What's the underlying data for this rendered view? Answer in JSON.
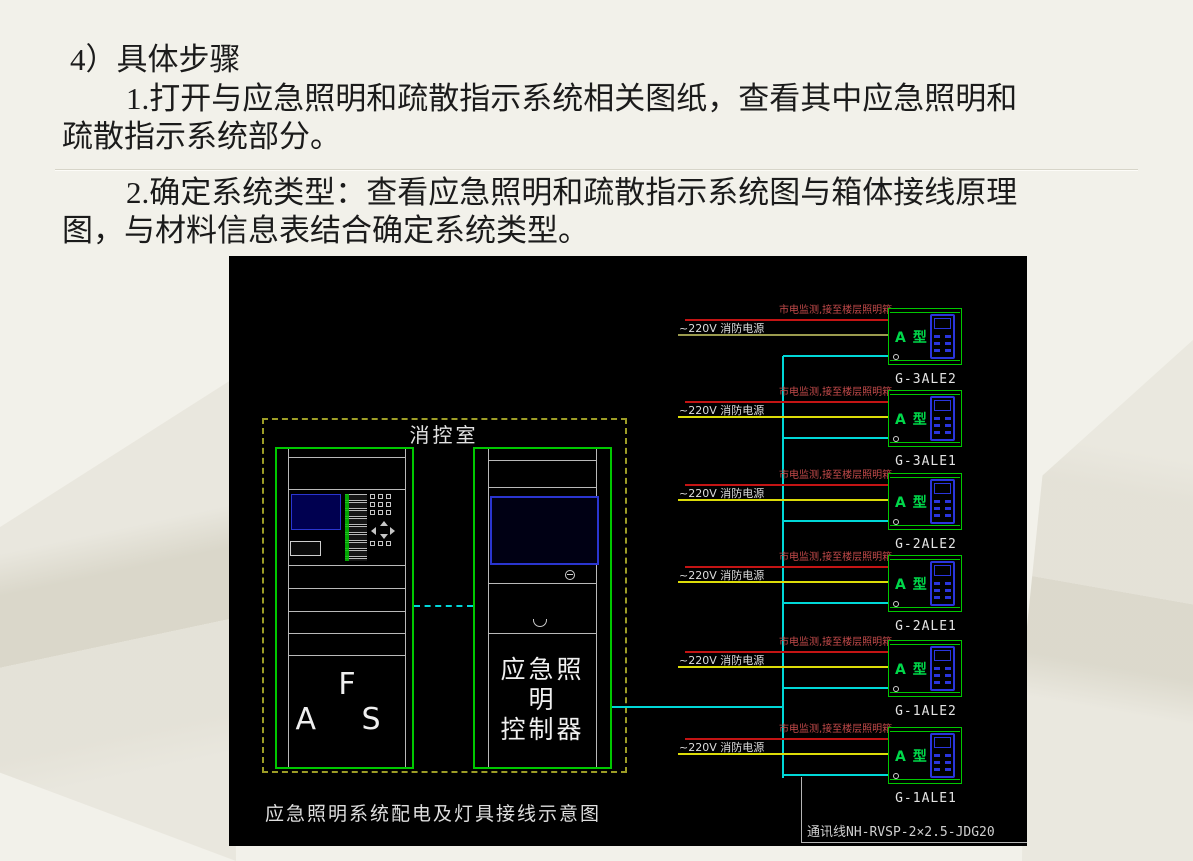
{
  "slide": {
    "background_color": "#f2f1ea",
    "heading": "4）具体步骤",
    "paragraphs": [
      {
        "line1": "1.打开与应急照明和疏散指示系统相关图纸，查看其中应急照明和",
        "line2": "疏散指示系统部分。"
      },
      {
        "line1": "2.确定系统类型：查看应急照明和疏散指示系统图与箱体接线原理",
        "line2": "图，与材料信息表结合确定系统类型。"
      }
    ]
  },
  "diagram": {
    "title": "应急照明系统配电及灯具接线示意图",
    "room_label": "消控室",
    "fas_cabinet_label": "F A S",
    "controller_label_line1": "应急照明",
    "controller_label_line2": "控制器",
    "comm_line_label": "通讯线NH-RVSP-2×2.5-JDG20",
    "floor_units": [
      {
        "id": "G-3ALE2",
        "mains_label": "市电监测,接至楼层照明箱",
        "power_label": "~220V 消防电源",
        "type_label": "A 型"
      },
      {
        "id": "G-3ALE1",
        "mains_label": "市电监测,接至楼层照明箱",
        "power_label": "~220V 消防电源",
        "type_label": "A 型"
      },
      {
        "id": "G-2ALE2",
        "mains_label": "市电监测,接至楼层照明箱",
        "power_label": "~220V 消防电源",
        "type_label": "A 型"
      },
      {
        "id": "G-2ALE1",
        "mains_label": "市电监测,接至楼层照明箱",
        "power_label": "~220V 消防电源",
        "type_label": "A 型"
      },
      {
        "id": "G-1ALE2",
        "mains_label": "市电监测,接至楼层照明箱",
        "power_label": "~220V 消防电源",
        "type_label": "A 型"
      },
      {
        "id": "G-1ALE1",
        "mains_label": "市电监测,接至楼层照明箱",
        "power_label": "~220V 消防电源",
        "type_label": "A 型"
      }
    ],
    "colors": {
      "canvas_background": "#000000",
      "cabinet_border_green": "#00c800",
      "room_border_dashed_olive": "#9c9c26",
      "mains_wire_red": "#c41414",
      "fire_power_wire_yellow": "#dcdc08",
      "comm_wire_cyan": "#00d8d8",
      "device_icon_blue": "#2a35dd",
      "label_white": "#e3e3e3",
      "mains_label_red": "#c24a4a"
    }
  }
}
